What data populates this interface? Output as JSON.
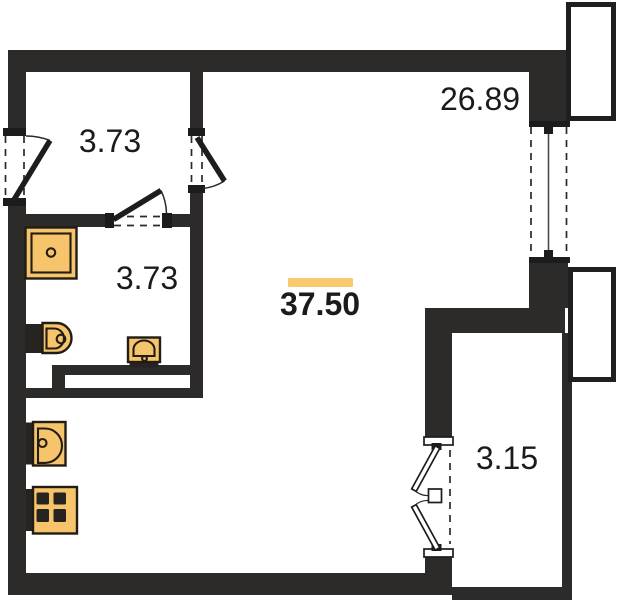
{
  "plan": {
    "type": "apartment-floor-plan",
    "labels": {
      "hallway_area": "3.73",
      "bathroom_area": "3.73",
      "living_room_area": "26.89",
      "total_area": "37.50",
      "balcony_area": "3.15"
    },
    "colors": {
      "wall": "#2c2b29",
      "fixture_fill": "#f6c46a",
      "fixture_stroke": "#211d15",
      "highlight_bar": "#f8ca6c",
      "label_text": "#1b1b1b"
    },
    "fixtures": [
      "washing-machine",
      "toilet",
      "bathroom-sink",
      "kitchen-sink",
      "stove"
    ],
    "openings": [
      "entrance-door",
      "hall-room-door",
      "bathroom-door",
      "window",
      "balcony-french-door"
    ]
  }
}
